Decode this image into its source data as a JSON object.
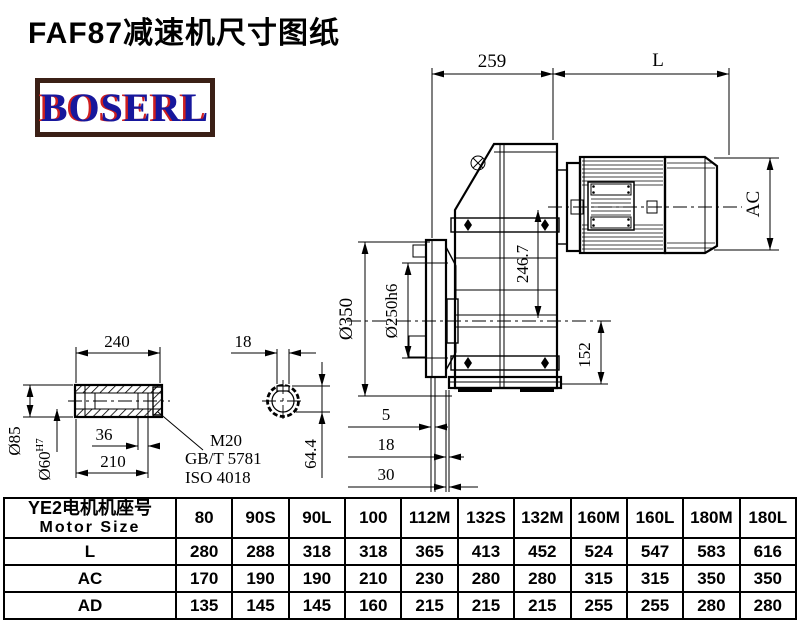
{
  "page": {
    "title": "FAF87减速机尺寸图纸"
  },
  "logo": {
    "text": "BOSERL"
  },
  "drawing": {
    "main_view": {
      "dim_259": "259",
      "dim_L": "L",
      "dim_AC": "AC",
      "dim_246_7": "246.7",
      "dim_152": "152",
      "dim_350": "Ø350",
      "dim_250h6": "Ø250h6",
      "dim_5": "5",
      "dim_18": "18",
      "dim_30": "30"
    },
    "shaft_view": {
      "dim_240": "240",
      "dim_85": "Ø85",
      "dim_60": "Ø60",
      "dim_60_sup": "H7",
      "dim_36": "36",
      "dim_210": "210",
      "thread_label": "M20",
      "standard_1": "GB/T 5781",
      "standard_2": "ISO 4018"
    },
    "shaft_end_view": {
      "dim_18": "18",
      "dim_64_4": "64.4"
    }
  },
  "table": {
    "header": {
      "line1": "YE2电机机座号",
      "line2": "Motor Size"
    },
    "columns": [
      "80",
      "90S",
      "90L",
      "100",
      "112M",
      "132S",
      "132M",
      "160M",
      "160L",
      "180M",
      "180L"
    ],
    "rows": [
      {
        "label": "L",
        "values": [
          "280",
          "288",
          "318",
          "318",
          "365",
          "413",
          "452",
          "524",
          "547",
          "583",
          "616"
        ]
      },
      {
        "label": "AC",
        "values": [
          "170",
          "190",
          "190",
          "210",
          "230",
          "280",
          "280",
          "315",
          "315",
          "350",
          "350"
        ]
      },
      {
        "label": "AD",
        "values": [
          "135",
          "145",
          "145",
          "160",
          "215",
          "215",
          "215",
          "255",
          "255",
          "280",
          "280"
        ]
      }
    ]
  }
}
